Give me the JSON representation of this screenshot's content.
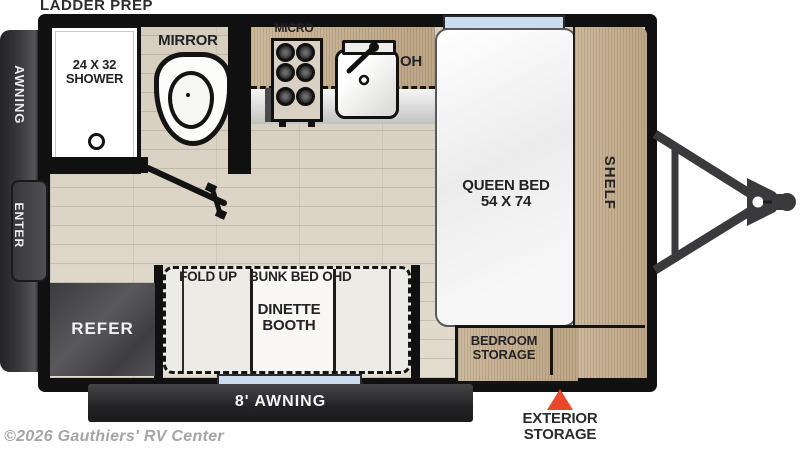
{
  "floorplan": {
    "prep_label": "LADDER PREP",
    "copyright": "©2026 Gauthiers' RV Center",
    "left_side": {
      "awning": "AWNING",
      "enter": "ENTER"
    },
    "bathroom": {
      "shower_line1": "24 X 32",
      "shower_line2": "SHOWER",
      "mirror": "MIRROR"
    },
    "kitchen": {
      "micro": "MICRO",
      "oh": "OH"
    },
    "bedroom": {
      "bed_line1": "QUEEN BED",
      "bed_line2": "54 X 74",
      "shelf": "SHELF",
      "storage_line1": "BEDROOM",
      "storage_line2": "STORAGE"
    },
    "dinette": {
      "fold_up": "FOLD UP",
      "bunk_bed": "BUNK BED OHD",
      "booth_line1": "DINETTE",
      "booth_line2": "BOOTH"
    },
    "refer": "REFER",
    "bottom": {
      "awning_8": "8' AWNING",
      "exterior_line1": "EXTERIOR",
      "exterior_line2": "STORAGE"
    },
    "colors": {
      "accent_triangle": "#e8492b",
      "window_blue": "#cadcee",
      "wall": "#101010",
      "counter_wood": "#c6b094",
      "floor_wood": "#dcd5c7"
    }
  }
}
